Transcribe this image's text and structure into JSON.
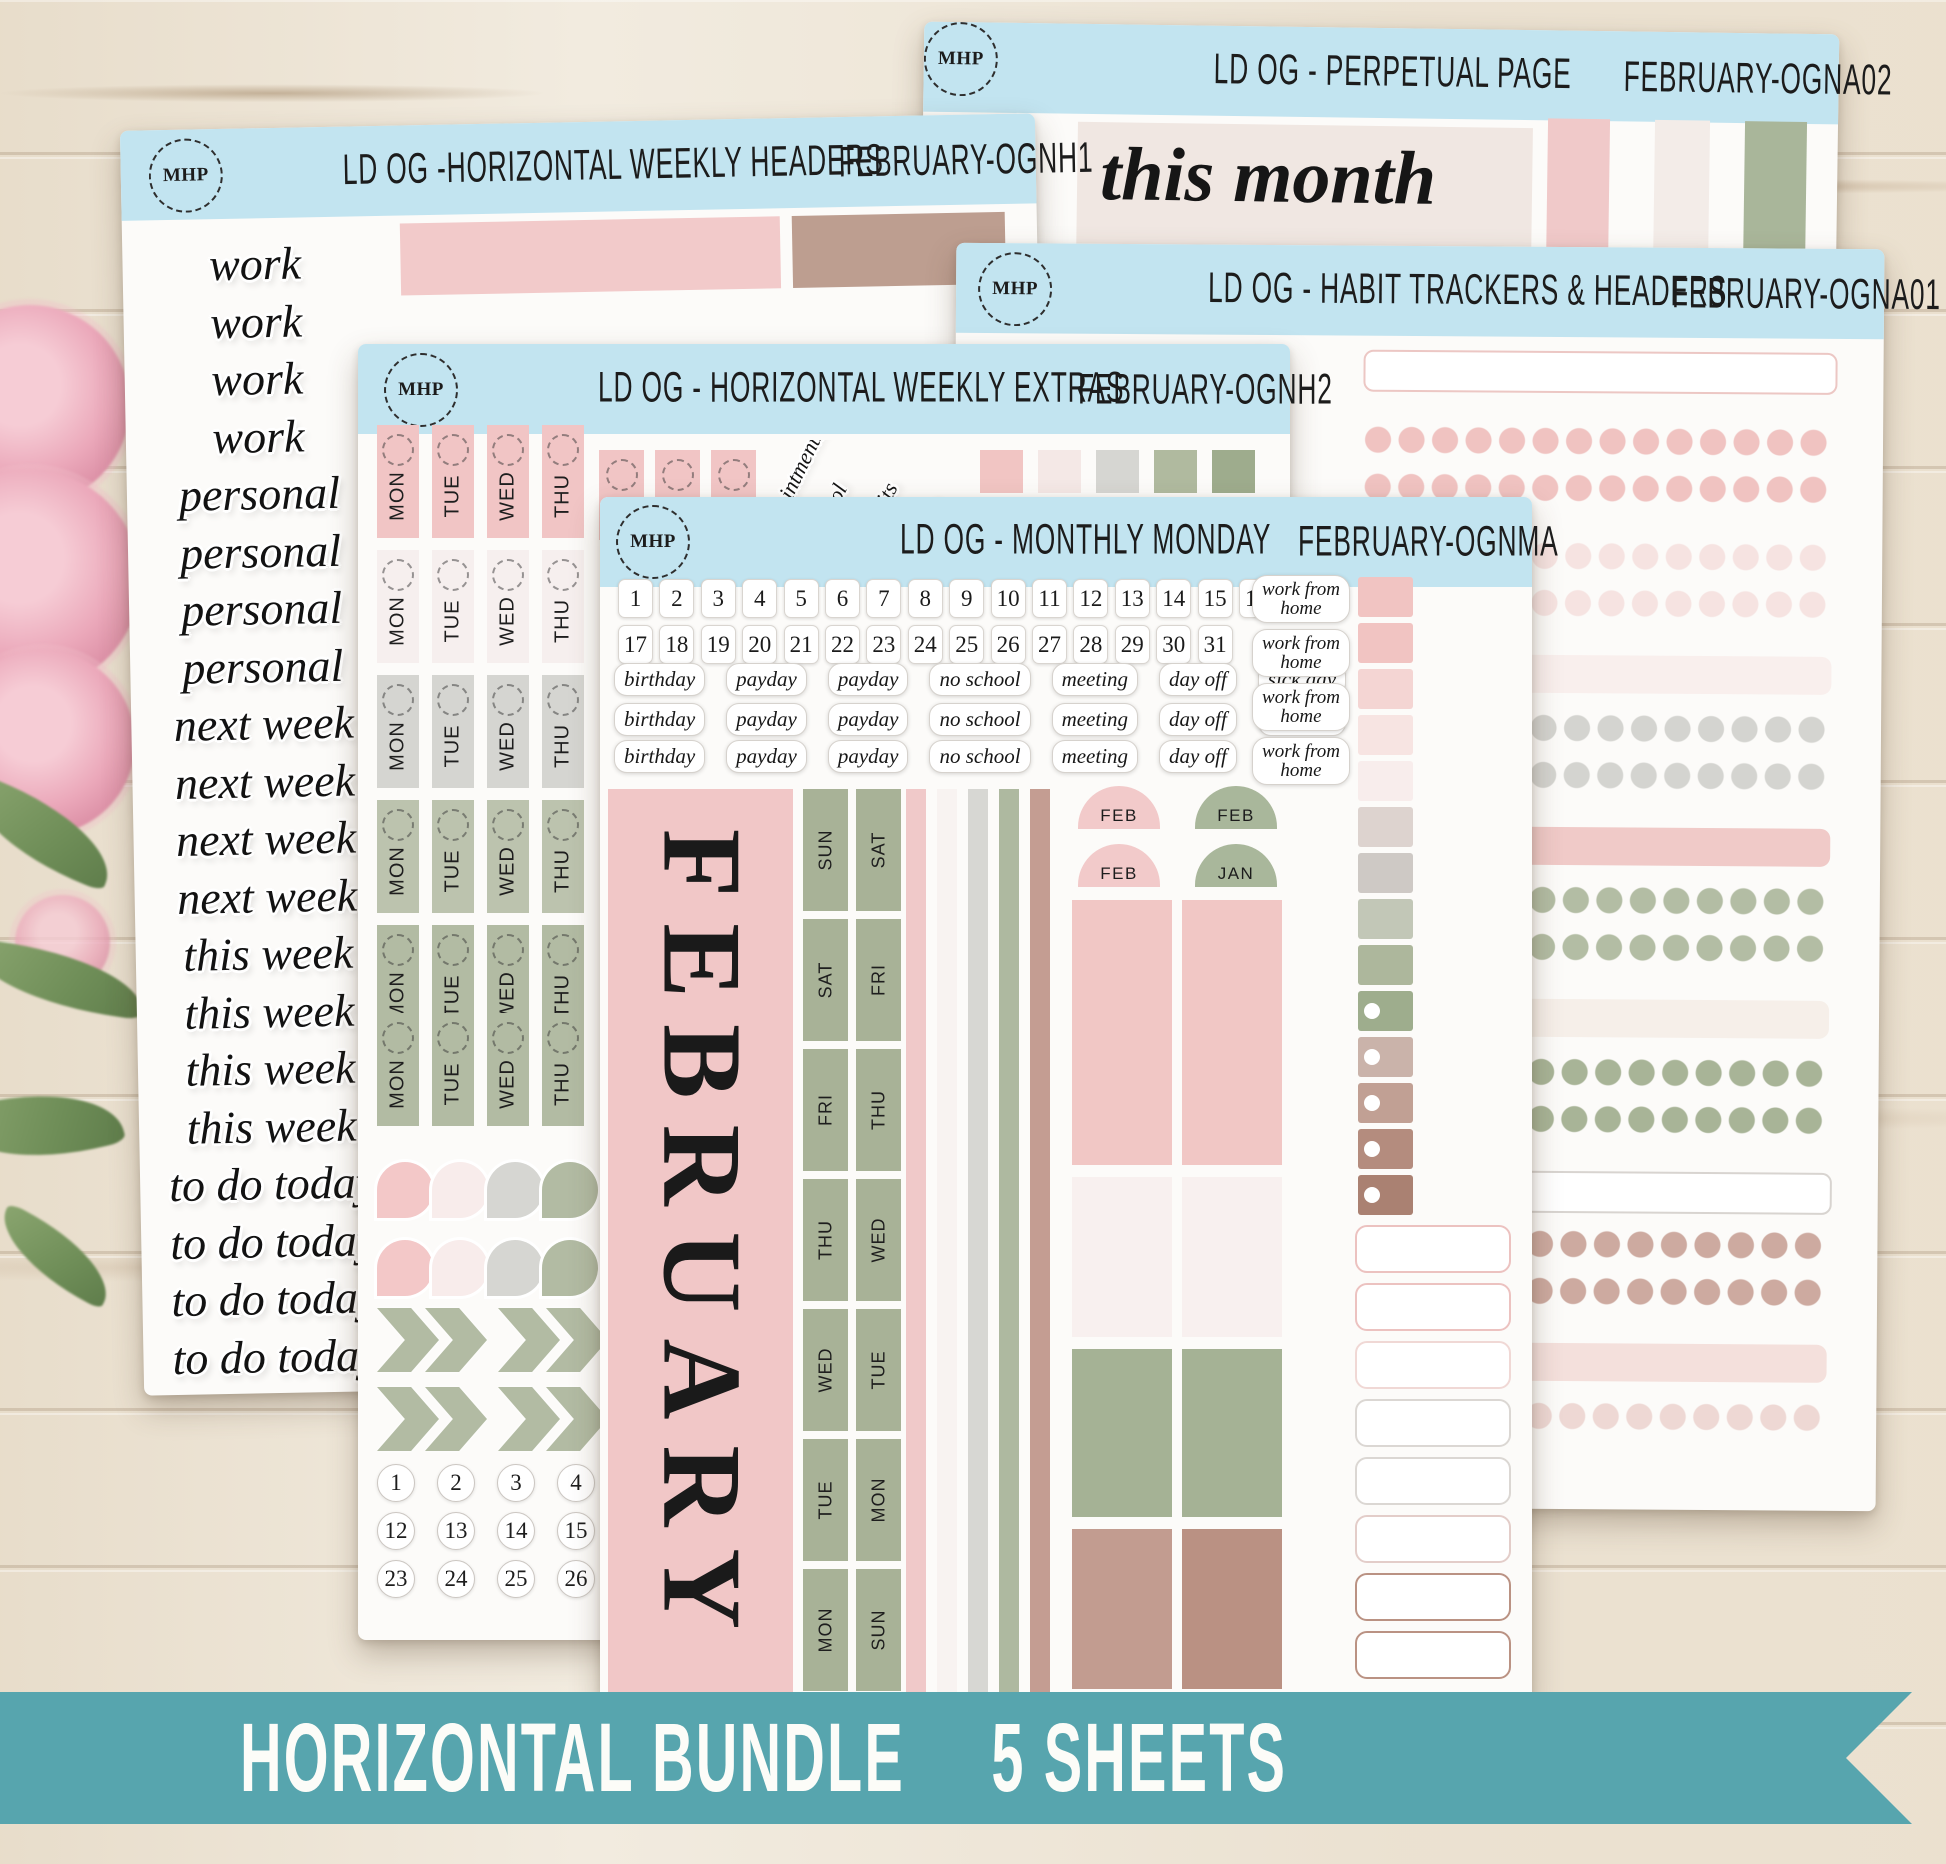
{
  "logo_text": "MHP",
  "header_color": "#c2e4f0",
  "banner": {
    "label_bundle": "HORIZONTAL BUNDLE",
    "label_count": "5 SHEETS",
    "color": "#57a5ae"
  },
  "sheets": {
    "perpetual": {
      "title": "LD OG - PERPETUAL PAGE",
      "code": "FEBRUARY-OGNA02",
      "script_label": "this month",
      "swatches": [
        "#f0c9c9",
        "#f3ece8",
        "#a9b69a"
      ]
    },
    "weekly_headers": {
      "title": "LD OG -HORIZONTAL WEEKLY HEADERS",
      "code": "FEBRUARY-OGNH1",
      "words": [
        "work",
        "work",
        "work",
        "work",
        "personal",
        "personal",
        "personal",
        "personal",
        "next week",
        "next week",
        "next week",
        "next week",
        "this week",
        "this week",
        "this week",
        "this week",
        "to do today",
        "to do today",
        "to do today",
        "to do today"
      ],
      "bar_colors": [
        "#f2caca",
        "#bd9e90"
      ]
    },
    "habit": {
      "title": "LD OG - HABIT TRACKERS & HEADERS",
      "code": "FEBRUARY-OGNA01",
      "rows": [
        {
          "k": "pillrow",
          "b": "#ecc7c4",
          "y": 104
        },
        {
          "k": "dots",
          "c": "#f0c3c1",
          "y": 179
        },
        {
          "k": "dots",
          "c": "#f0c3c1",
          "y": 226
        },
        {
          "k": "dots",
          "c": "#f6e3e1",
          "y": 294
        },
        {
          "k": "dots",
          "c": "#f6e3e1",
          "y": 341
        },
        {
          "k": "bar",
          "c": "#f9efed",
          "y": 408
        },
        {
          "k": "dots",
          "c": "#d4d4d0",
          "y": 466
        },
        {
          "k": "dots",
          "c": "#d4d4d0",
          "y": 513
        },
        {
          "k": "bar",
          "c": "#f0cac8",
          "y": 580
        },
        {
          "k": "dots",
          "c": "#b3bda4",
          "y": 638
        },
        {
          "k": "dots",
          "c": "#b3bda4",
          "y": 685
        },
        {
          "k": "bar",
          "c": "#f6efe9",
          "y": 752
        },
        {
          "k": "dots",
          "c": "#a8b497",
          "y": 810
        },
        {
          "k": "dots",
          "c": "#a8b497",
          "y": 857
        },
        {
          "k": "pillrow",
          "b": "#d8d4d0",
          "y": 924
        },
        {
          "k": "dots",
          "c": "#cdaaa0",
          "y": 982
        },
        {
          "k": "dots",
          "c": "#cdaaa0",
          "y": 1029
        },
        {
          "k": "bar",
          "c": "#f4e0dc",
          "y": 1096
        },
        {
          "k": "dots",
          "c": "#eed8d4",
          "y": 1154
        }
      ]
    },
    "weekly_extras": {
      "title": "LD OG - HORIZONTAL WEEKLY EXTRAS",
      "code": "FEBRUARY-OGNH2",
      "day_tabs": [
        "MON",
        "TUE",
        "WED",
        "THU"
      ],
      "tab_row_colors": [
        "#f1c5c5",
        "#f6efee",
        "#d5d5d1",
        "#bcc3ae",
        "#b2bba3",
        "#b2bba3"
      ],
      "slanted_labels": [
        "appointments",
        "school",
        "Habits",
        "Plan"
      ],
      "square_colors": [
        {
          "c": "#f1c5c3"
        },
        {
          "c": "#f4e8e6"
        },
        {
          "c": "#d6d6d2"
        },
        {
          "c": "#b0ba9f"
        },
        {
          "c": "#9eac8d"
        }
      ],
      "teardrops": [
        {
          "c": "#f3c8c8"
        },
        {
          "c": "#f8eceb"
        },
        {
          "c": "#d6d6d2"
        },
        {
          "c": "#b2bba3"
        },
        {
          "c": "#f3c8c8"
        },
        {
          "c": "#f8eceb"
        },
        {
          "c": "#d6d6d2"
        },
        {
          "c": "#b2bba3"
        }
      ],
      "numbers": [
        "1",
        "2",
        "3",
        "4",
        "12",
        "13",
        "14",
        "15",
        "23",
        "24",
        "25",
        "26"
      ]
    },
    "monthly": {
      "title": "LD OG - MONTHLY MONDAY",
      "code": "FEBRUARY-OGNMA",
      "dates_row1": [
        "1",
        "2",
        "3",
        "4",
        "5",
        "6",
        "7",
        "8",
        "9",
        "10",
        "11",
        "12",
        "13",
        "14",
        "15",
        "16"
      ],
      "dates_row2": [
        "17",
        "18",
        "19",
        "20",
        "21",
        "22",
        "23",
        "24",
        "25",
        "26",
        "27",
        "28",
        "29",
        "30",
        "31"
      ],
      "event_words": [
        "birthday",
        "payday",
        "payday",
        "no school",
        "meeting",
        "day off",
        "sick day"
      ],
      "wfh_stickers": [
        "work from home",
        "work from home",
        "work from home",
        "work from home"
      ],
      "month_name": "FEBRUARY",
      "day_col1": [
        "SUN",
        "SAT",
        "FRI",
        "THU",
        "WED",
        "TUE",
        "MON"
      ],
      "day_col2": [
        "SAT",
        "FRI",
        "THU",
        "WED",
        "TUE",
        "MON",
        "SUN"
      ],
      "month_tabs": [
        {
          "t": "FEB",
          "c": "#f2caca"
        },
        {
          "t": "FEB",
          "c": "#a9b79b"
        },
        {
          "t": "FEB",
          "c": "#f2caca"
        },
        {
          "t": "JAN",
          "c": "#a9b79b"
        }
      ],
      "stripes": [
        "#f0c9c9",
        "#f8f3f1",
        "#d7d7d3",
        "#aeb9a0",
        "#c49d92"
      ],
      "boxes": [
        "#f1c7c5",
        "#f1c7c5",
        "#f8f0ef",
        "#f8f0ef",
        "#a5b295",
        "#a5b295",
        "#c29c90",
        "#ba9183"
      ],
      "ombre_column": [
        {
          "k": "sq",
          "c": "#f1c4c2"
        },
        {
          "k": "sq",
          "c": "#f1c4c2"
        },
        {
          "k": "sq",
          "c": "#f4d5d3"
        },
        {
          "k": "sq",
          "c": "#f7e4e2"
        },
        {
          "k": "sq",
          "c": "#f8edec"
        },
        {
          "k": "sq",
          "c": "#ddd3cf"
        },
        {
          "k": "sq",
          "c": "#cec9c5"
        },
        {
          "k": "sq",
          "c": "#c2c7b7"
        },
        {
          "k": "sq",
          "c": "#adb79c"
        },
        {
          "k": "fl",
          "c": "#9ead8d"
        },
        {
          "k": "fl",
          "c": "#cab3aa"
        },
        {
          "k": "fl",
          "c": "#c1a094"
        },
        {
          "k": "fl",
          "c": "#b48c7e"
        },
        {
          "k": "fl",
          "c": "#aa8172"
        }
      ],
      "outlined_pills": [
        {
          "b": "#ecc2c0"
        },
        {
          "b": "#ecc2c0"
        },
        {
          "b": "#f0d8d5"
        },
        {
          "b": "#dbd7d3"
        },
        {
          "b": "#dbd7d3"
        },
        {
          "b": "#e3cdc9"
        },
        {
          "b": "#ba9283"
        },
        {
          "b": "#ba9283"
        }
      ]
    }
  }
}
